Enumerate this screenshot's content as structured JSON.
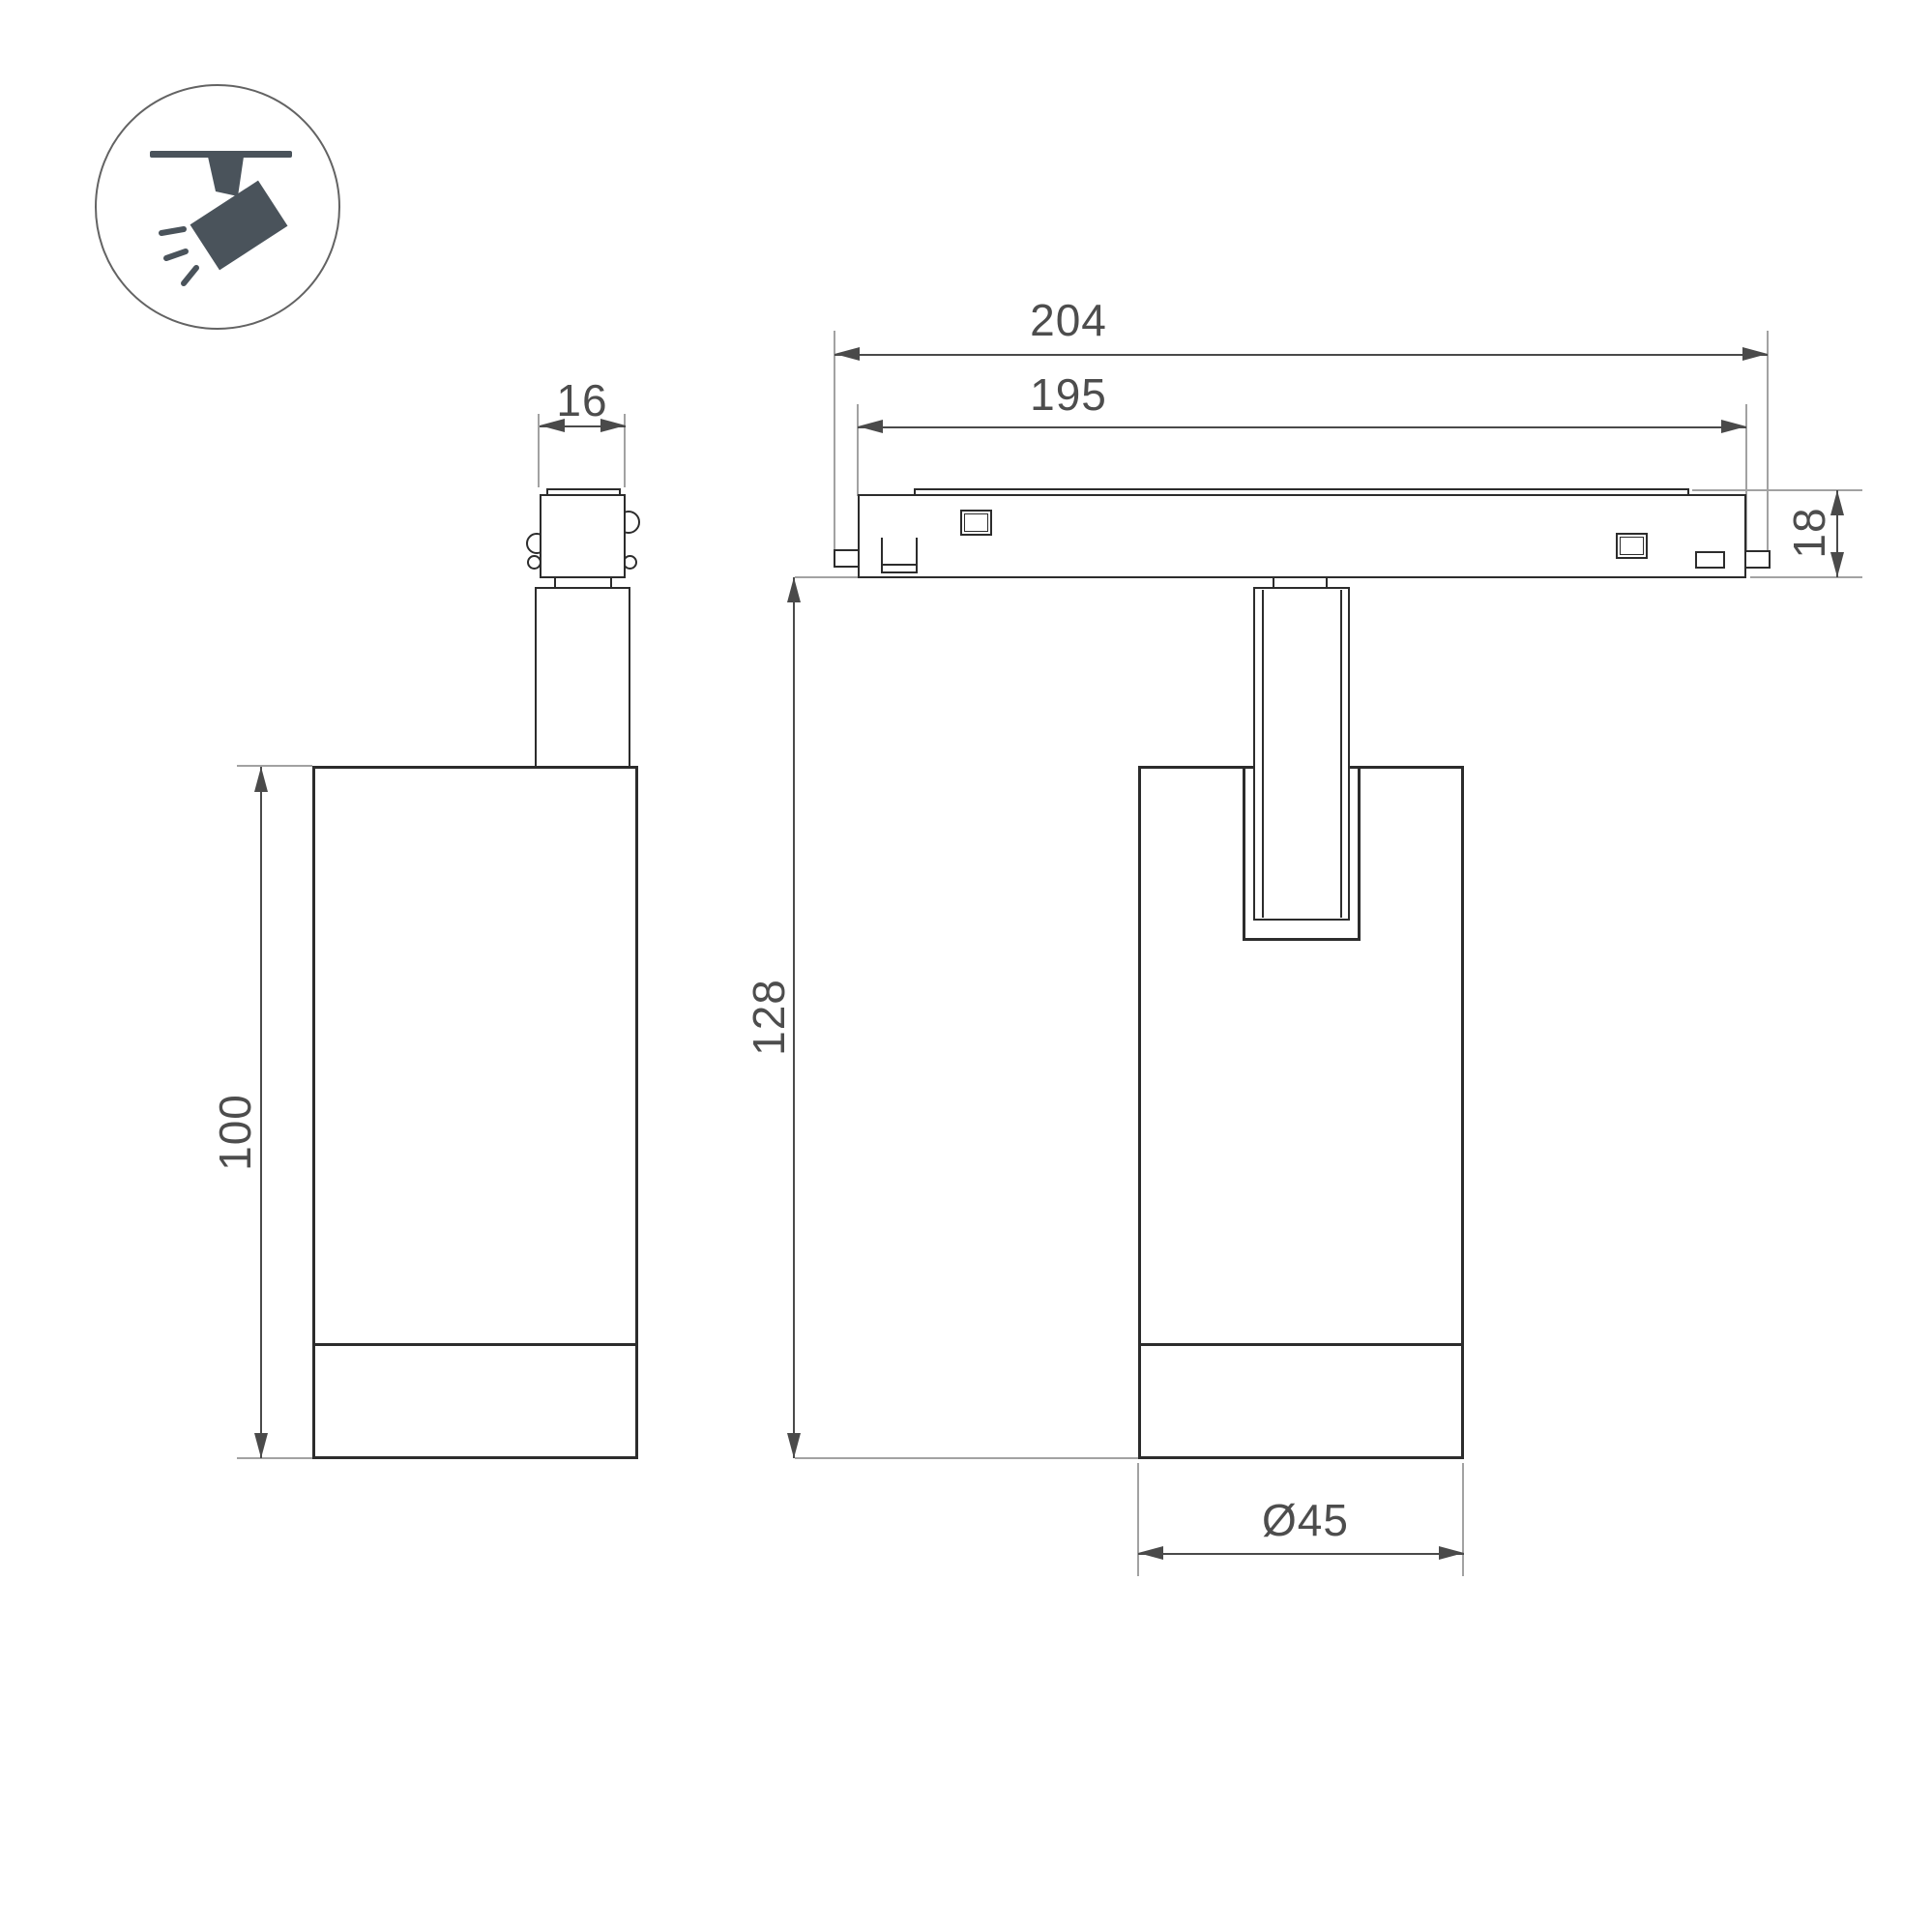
{
  "title": "track-spotlight-dimension-drawing",
  "icon": {
    "name": "ceiling-track-spotlight-icon",
    "color": "#4a535b",
    "ring_color": "#636363"
  },
  "dimensions": {
    "track_outer_length": "204",
    "track_inner_length": "195",
    "adapter_width": "16",
    "track_height": "18",
    "overall_height": "128",
    "body_height": "100",
    "body_diameter": "Ø45"
  },
  "colors": {
    "line": "#2c2c2c",
    "dim": "#4a4a4a",
    "ext": "#a2a2a2",
    "text": "#4d4d4d",
    "bg": "#ffffff"
  }
}
